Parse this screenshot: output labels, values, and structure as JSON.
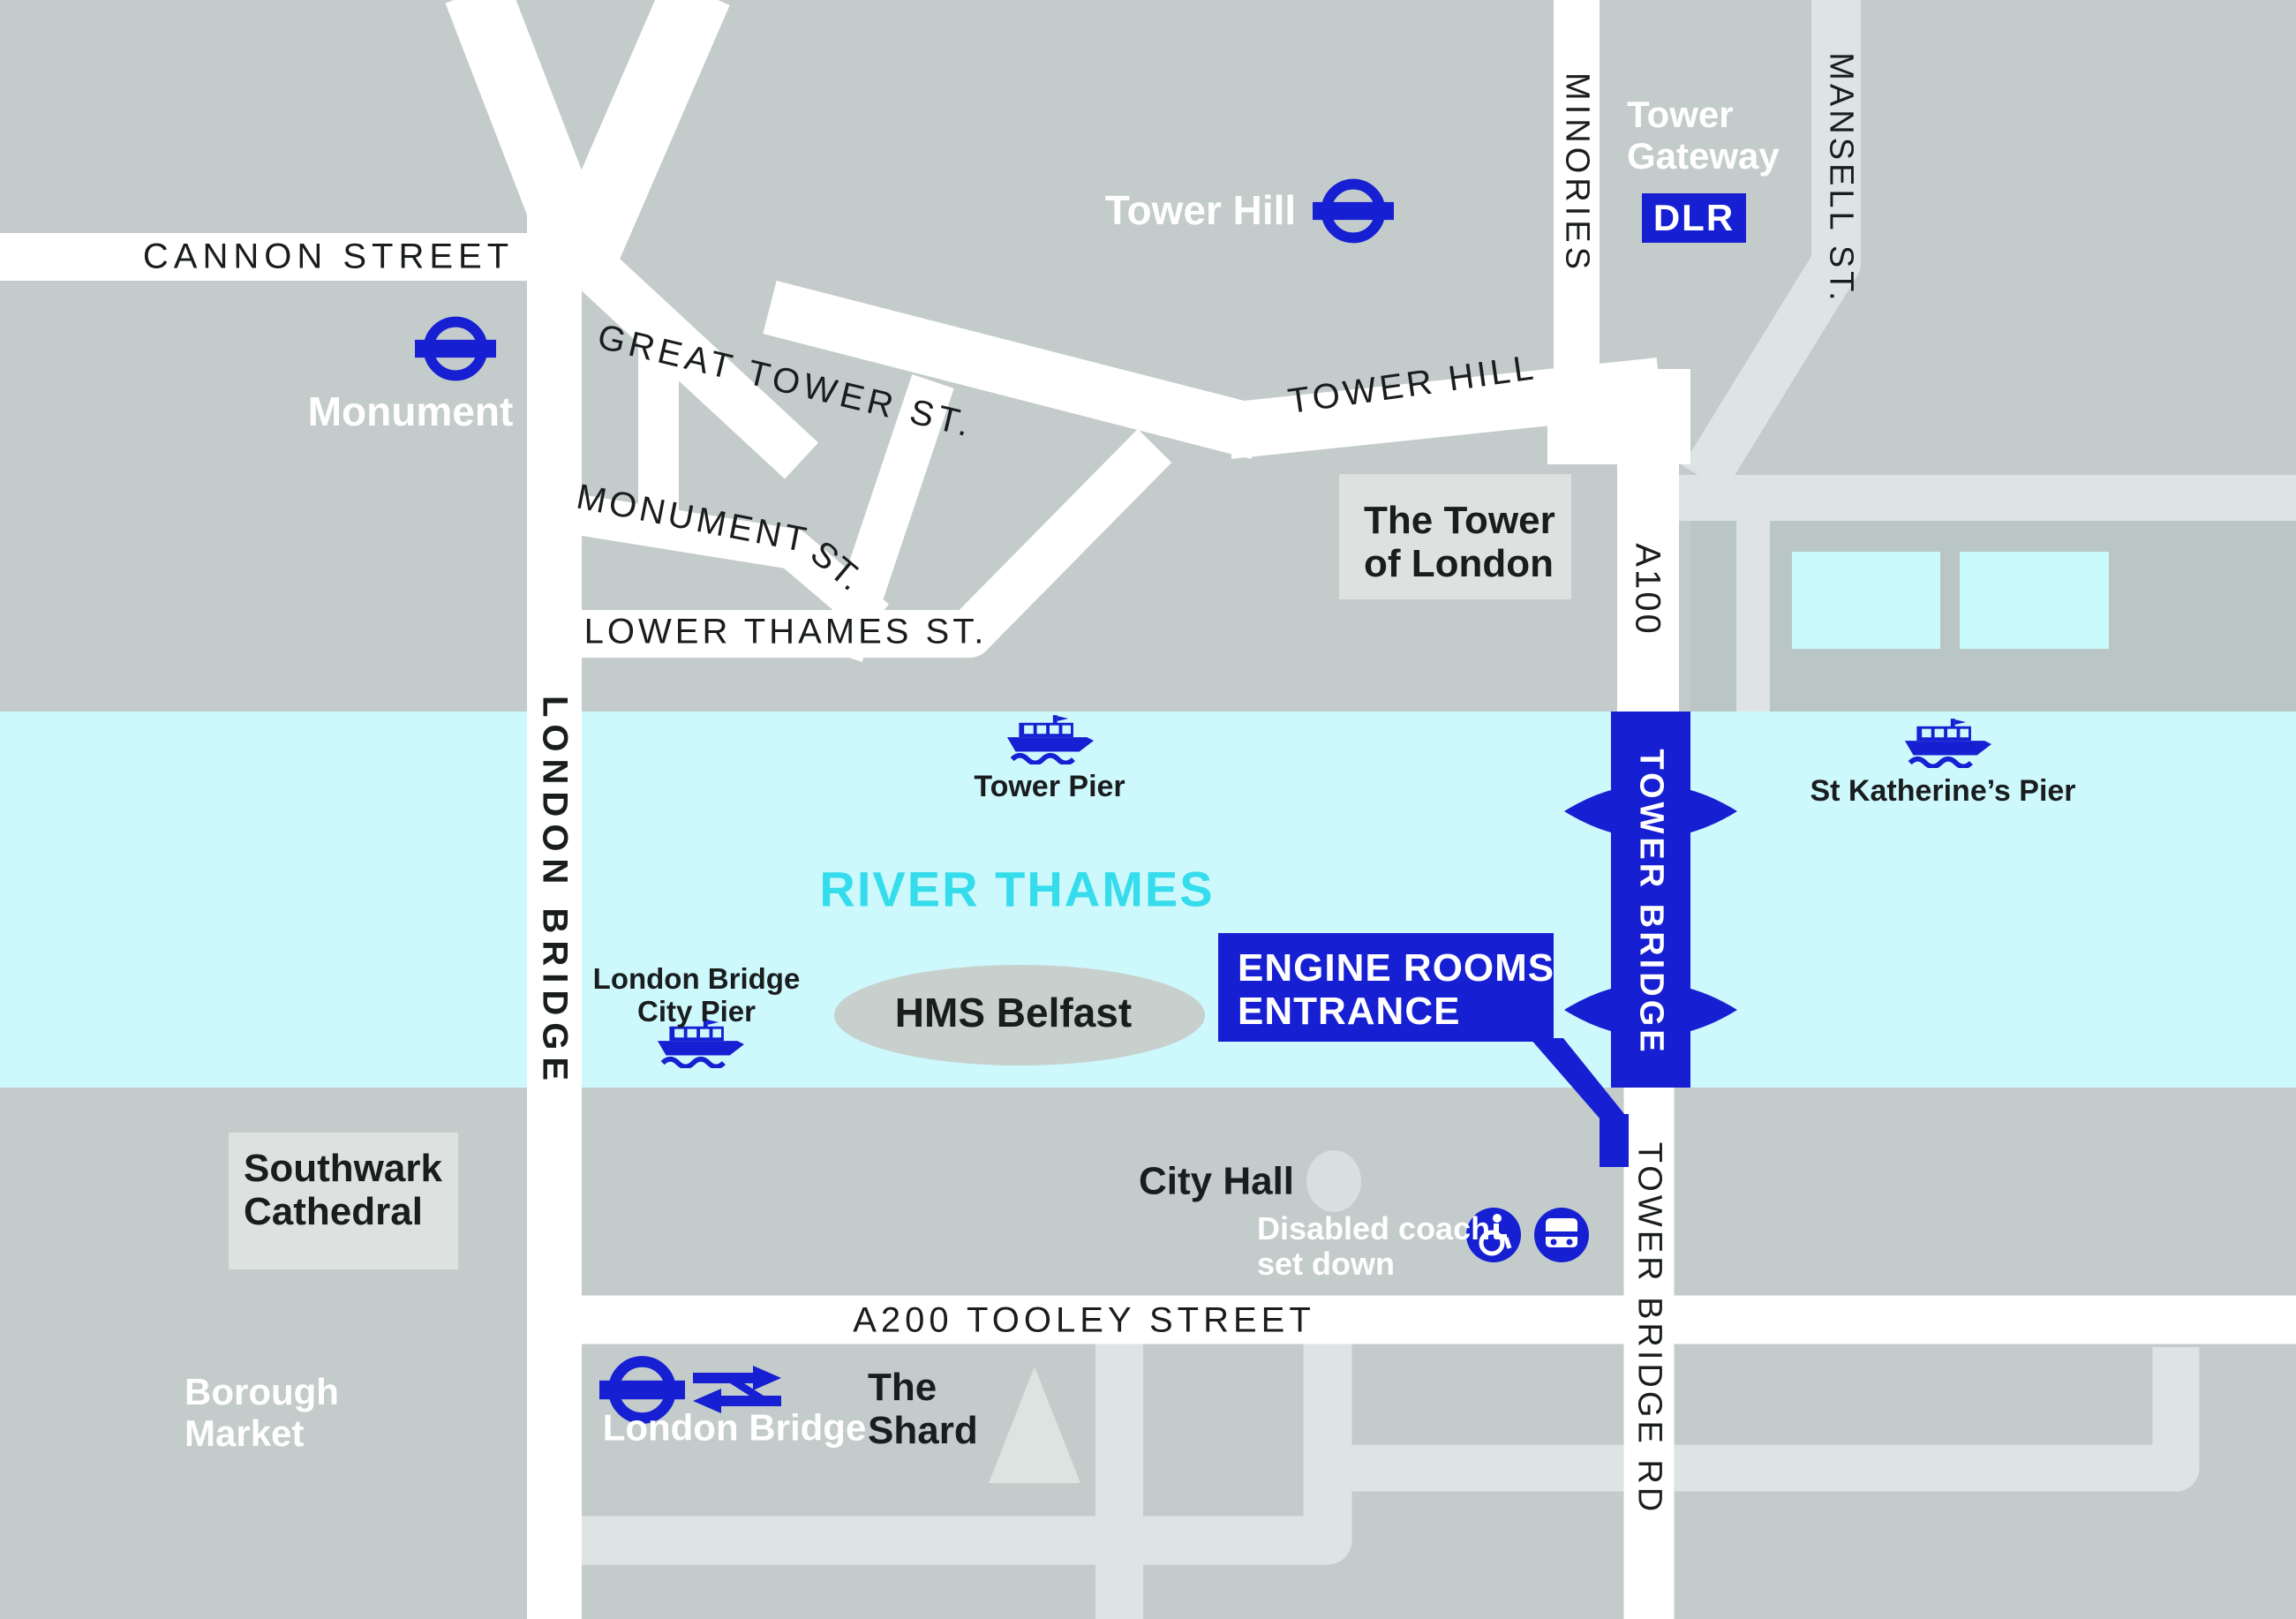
{
  "map": {
    "streets": {
      "cannon": "CANNON STREET",
      "great_tower": "GREAT TOWER ST.",
      "tower_hill_street": "TOWER HILL",
      "monument_st_1": "MONUMENT",
      "monument_st_2": "ST.",
      "lower_thames": "LOWER THAMES ST.",
      "minories": "MINORIES",
      "mansell": "MANSELL ST.",
      "a100": "A100",
      "london_bridge_vertical": "LONDON BRIDGE",
      "tower_bridge_vertical": "TOWER BRIDGE",
      "tower_bridge_rd": "TOWER BRIDGE RD",
      "tooley": "A200 TOOLEY STREET"
    },
    "stations": {
      "monument": "Monument",
      "tower_hill": "Tower Hill",
      "tower_gateway_line1": "Tower",
      "tower_gateway_line2": "Gateway",
      "dlr_badge": "DLR",
      "london_bridge": "London Bridge"
    },
    "piers": {
      "tower_pier": "Tower Pier",
      "st_katherines_pier": "St Katherine’s Pier",
      "lb_city_pier_line1": "London Bridge",
      "lb_city_pier_line2": "City Pier"
    },
    "landmarks": {
      "river": "RIVER THAMES",
      "hms_belfast": "HMS Belfast",
      "tower_of_london_line1": "The Tower",
      "tower_of_london_line2": "of London",
      "southwark_line1": "Southwark",
      "southwark_line2": "Cathedral",
      "borough_line1": "Borough",
      "borough_line2": "Market",
      "shard_line1": "The",
      "shard_line2": "Shard",
      "city_hall": "City Hall"
    },
    "callout": {
      "line1": "ENGINE ROOMS",
      "line2": "ENTRANCE"
    },
    "notes": {
      "disabled_line1": "Disabled coach",
      "disabled_line2": "set down"
    },
    "colors": {
      "background_gray": "#c3cccb",
      "darker_block_gray": "#bac5c5",
      "road_white": "#ffffff",
      "minor_road_gray": "#dde4e3",
      "label_box_gray": "#dde2e1",
      "river_cyan": "#cdf8fc",
      "dock_cyan": "#c9fbfd",
      "river_text_cyan": "#35dcec",
      "brand_blue": "#1620d2",
      "hms_ellipse_gray": "#c8d0cd",
      "city_hall_circle_gray": "#d9dfde",
      "text_black": "#1a1d1e"
    }
  }
}
